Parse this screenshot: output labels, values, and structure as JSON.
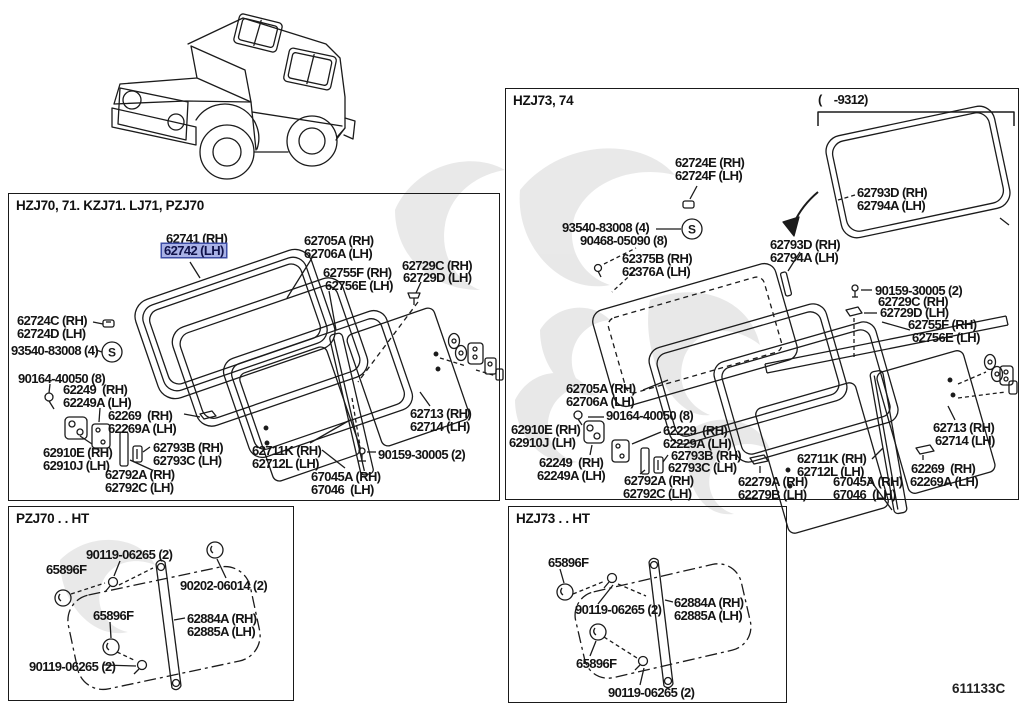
{
  "figure_code": "611133C",
  "highlight": {
    "fill": "#a9b2e6",
    "border": "#3d4da6"
  },
  "panels": [
    {
      "key": "hzj70",
      "title": "HZJ70, 71. KZJ71. LJ71, PZJ70",
      "labels": [
        {
          "text": "62741 (RH)",
          "x": 166,
          "y": 232
        },
        {
          "text": "62742 (LH)",
          "x": 164,
          "y": 245,
          "hl": true
        },
        {
          "text": "62705A (RH)",
          "x": 304,
          "y": 234
        },
        {
          "text": "62706A (LH)",
          "x": 304,
          "y": 247
        },
        {
          "text": "62755F (RH)",
          "x": 323,
          "y": 266
        },
        {
          "text": "62756E (LH)",
          "x": 325,
          "y": 279
        },
        {
          "text": "62729C (RH)",
          "x": 402,
          "y": 259
        },
        {
          "text": "62729D (LH)",
          "x": 403,
          "y": 271
        },
        {
          "text": "62724C (RH)",
          "x": 17,
          "y": 314
        },
        {
          "text": "62724D (LH)",
          "x": 17,
          "y": 327
        },
        {
          "text": "93540-83008 (4)",
          "x": 11,
          "y": 344
        },
        {
          "text": "90164-40050 (8)",
          "x": 18,
          "y": 372
        },
        {
          "text": "62249  (RH)",
          "x": 63,
          "y": 383
        },
        {
          "text": "62249A (LH)",
          "x": 63,
          "y": 396
        },
        {
          "text": "62269  (RH)",
          "x": 108,
          "y": 409
        },
        {
          "text": "62269A (LH)",
          "x": 108,
          "y": 422
        },
        {
          "text": "62910E (RH)",
          "x": 43,
          "y": 446
        },
        {
          "text": "62910J (LH)",
          "x": 43,
          "y": 459
        },
        {
          "text": "62793B (RH)",
          "x": 153,
          "y": 441
        },
        {
          "text": "62793C (LH)",
          "x": 153,
          "y": 454
        },
        {
          "text": "62792A (RH)",
          "x": 105,
          "y": 468
        },
        {
          "text": "62792C (LH)",
          "x": 105,
          "y": 481
        },
        {
          "text": "62711K (RH)",
          "x": 252,
          "y": 444
        },
        {
          "text": "62712L (LH)",
          "x": 252,
          "y": 457
        },
        {
          "text": "67045A (RH)",
          "x": 311,
          "y": 470
        },
        {
          "text": "67046  (LH)",
          "x": 311,
          "y": 483
        },
        {
          "text": "62713 (RH)",
          "x": 410,
          "y": 407
        },
        {
          "text": "62714 (LH)",
          "x": 410,
          "y": 420
        },
        {
          "text": "90159-30005 (2)",
          "x": 378,
          "y": 448
        }
      ]
    },
    {
      "key": "hzj73-74",
      "title": "HZJ73, 74",
      "labels": [
        {
          "text": "(    -9312)",
          "x": 818,
          "y": 93
        },
        {
          "text": "62724E (RH)",
          "x": 675,
          "y": 156
        },
        {
          "text": "62724F (LH)",
          "x": 675,
          "y": 169
        },
        {
          "text": "62793D (RH)",
          "x": 857,
          "y": 186
        },
        {
          "text": "62794A (LH)",
          "x": 857,
          "y": 199
        },
        {
          "text": "93540-83008 (4)",
          "x": 562,
          "y": 221
        },
        {
          "text": "90468-05090 (8)",
          "x": 580,
          "y": 234
        },
        {
          "text": "62375B (RH)",
          "x": 622,
          "y": 252
        },
        {
          "text": "62376A (LH)",
          "x": 622,
          "y": 265
        },
        {
          "text": "62793D (RH)",
          "x": 770,
          "y": 238
        },
        {
          "text": "62794A (LH)",
          "x": 770,
          "y": 251
        },
        {
          "text": "90159-30005 (2)",
          "x": 875,
          "y": 284
        },
        {
          "text": "62729C (RH)",
          "x": 878,
          "y": 295
        },
        {
          "text": "62729D (LH)",
          "x": 880,
          "y": 306
        },
        {
          "text": "62755F (RH)",
          "x": 908,
          "y": 318
        },
        {
          "text": "62756E (LH)",
          "x": 912,
          "y": 331
        },
        {
          "text": "62705A (RH)",
          "x": 566,
          "y": 382
        },
        {
          "text": "62706A (LH)",
          "x": 566,
          "y": 395
        },
        {
          "text": "90164-40050 (8)",
          "x": 606,
          "y": 409
        },
        {
          "text": "62910E (RH)",
          "x": 511,
          "y": 423
        },
        {
          "text": "62910J (LH)",
          "x": 509,
          "y": 436
        },
        {
          "text": "62229  (RH)",
          "x": 663,
          "y": 424
        },
        {
          "text": "62229A (LH)",
          "x": 663,
          "y": 437
        },
        {
          "text": "62793B (RH)",
          "x": 671,
          "y": 449
        },
        {
          "text": "62793C (LH)",
          "x": 668,
          "y": 461
        },
        {
          "text": "62249  (RH)",
          "x": 539,
          "y": 456
        },
        {
          "text": "62249A (LH)",
          "x": 537,
          "y": 469
        },
        {
          "text": "62792A (RH)",
          "x": 624,
          "y": 474
        },
        {
          "text": "62792C (LH)",
          "x": 623,
          "y": 487
        },
        {
          "text": "62279A (RH)",
          "x": 738,
          "y": 475
        },
        {
          "text": "62279B (LH)",
          "x": 738,
          "y": 488
        },
        {
          "text": "62711K (RH)",
          "x": 797,
          "y": 452
        },
        {
          "text": "62712L (LH)",
          "x": 797,
          "y": 465
        },
        {
          "text": "67045A (RH)",
          "x": 833,
          "y": 475
        },
        {
          "text": "67046  (LH)",
          "x": 833,
          "y": 488
        },
        {
          "text": "62713 (RH)",
          "x": 933,
          "y": 421
        },
        {
          "text": "62714 (LH)",
          "x": 935,
          "y": 434
        },
        {
          "text": "62269  (RH)",
          "x": 911,
          "y": 462
        },
        {
          "text": "62269A (LH)",
          "x": 910,
          "y": 475
        }
      ]
    },
    {
      "key": "pzj70-ht",
      "title": "PZJ70 . . HT",
      "labels": [
        {
          "text": "90119-06265 (2)",
          "x": 86,
          "y": 548
        },
        {
          "text": "65896F",
          "x": 46,
          "y": 563
        },
        {
          "text": "90202-06014 (2)",
          "x": 180,
          "y": 579
        },
        {
          "text": "65896F",
          "x": 93,
          "y": 609
        },
        {
          "text": "62884A (RH)",
          "x": 187,
          "y": 612
        },
        {
          "text": "62885A (LH)",
          "x": 187,
          "y": 625
        },
        {
          "text": "90119-06265 (2)",
          "x": 29,
          "y": 660
        }
      ]
    },
    {
      "key": "hzj73-ht",
      "title": "HZJ73 . . HT",
      "labels": [
        {
          "text": "65896F",
          "x": 548,
          "y": 556
        },
        {
          "text": "90119-06265 (2)",
          "x": 575,
          "y": 603
        },
        {
          "text": "62884A (RH)",
          "x": 674,
          "y": 596
        },
        {
          "text": "62885A (LH)",
          "x": 674,
          "y": 609
        },
        {
          "text": "65896F",
          "x": 576,
          "y": 657
        },
        {
          "text": "90119-06265 (2)",
          "x": 608,
          "y": 686
        }
      ]
    }
  ]
}
